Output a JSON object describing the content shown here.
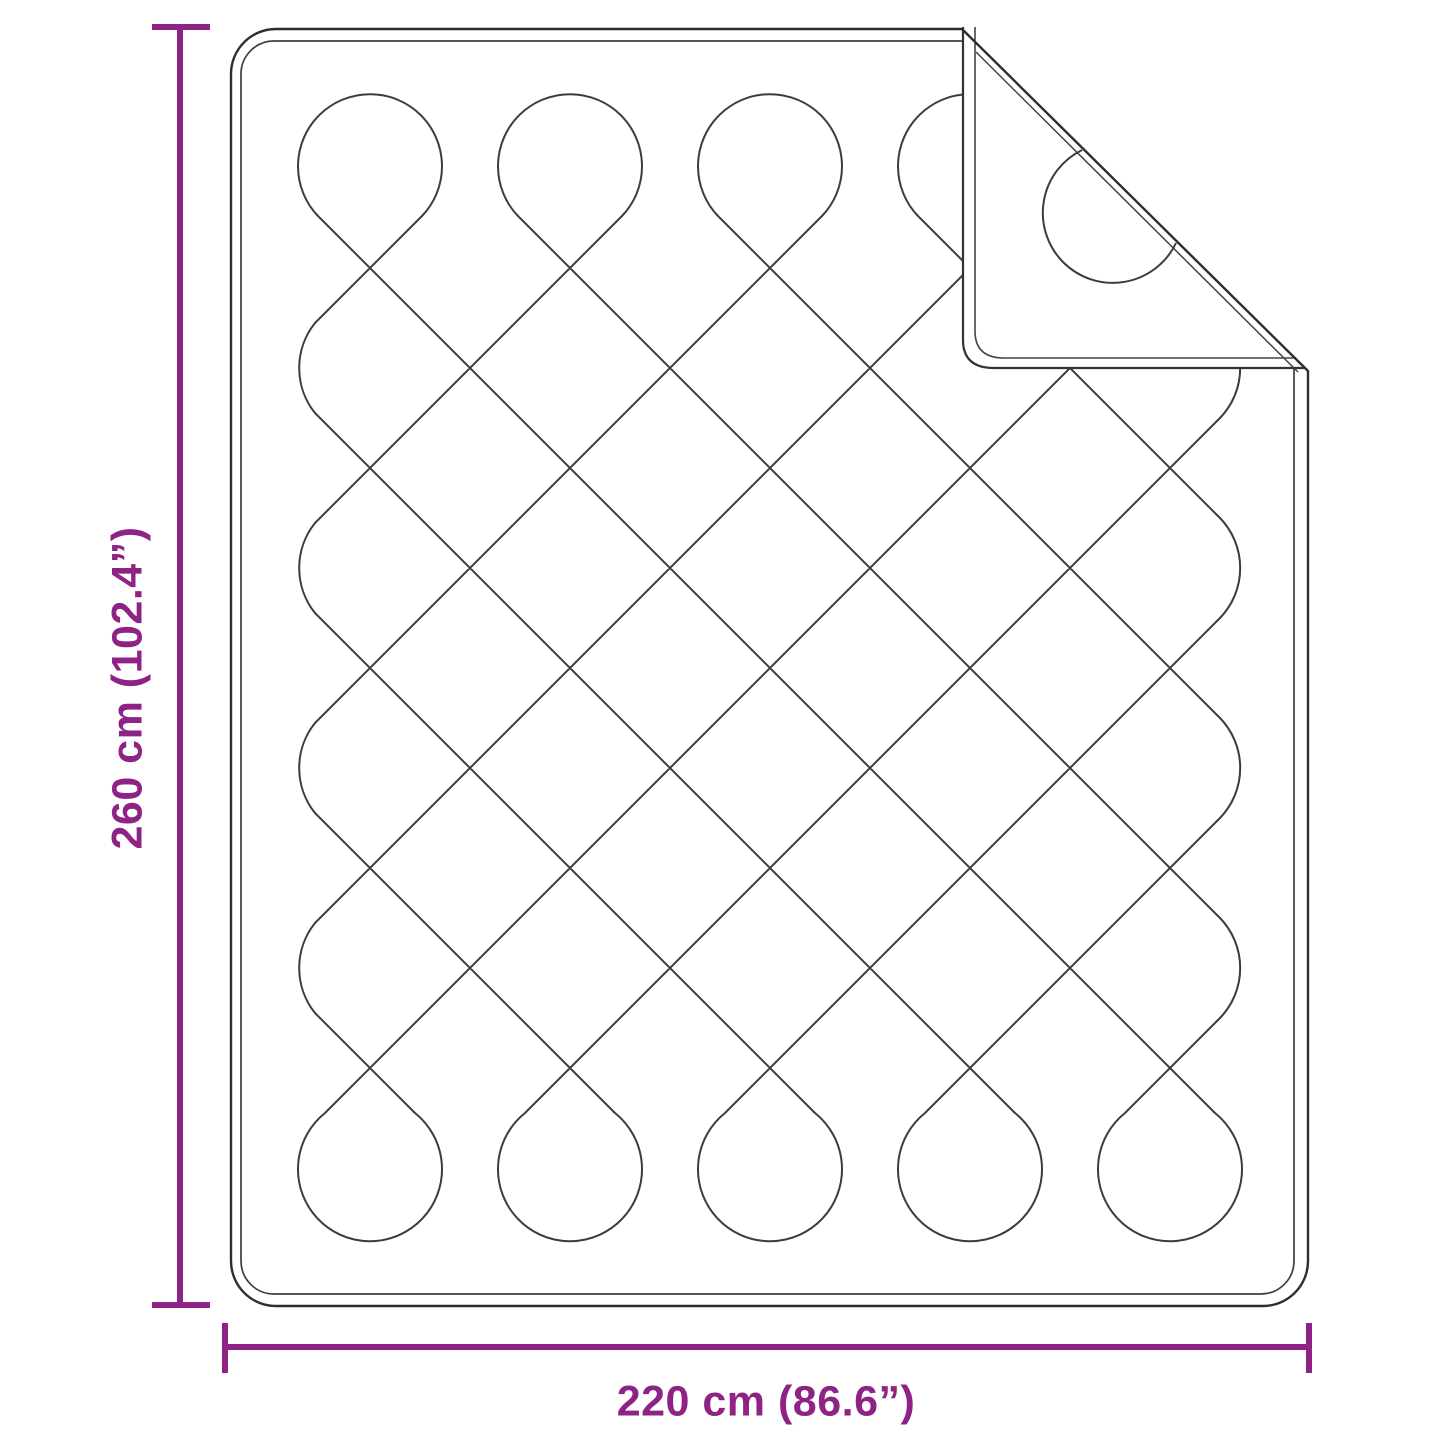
{
  "page": {
    "background": "#ffffff"
  },
  "diagram": {
    "description": "Quilted blanket dimension diagram with folded corner",
    "accent_color": "#8e2385",
    "outline_color": "#2e2e2e",
    "stitch_color": "#3c3c3c"
  },
  "labels": {
    "height": "260 cm (102.4”)",
    "width": "220 cm (86.6”)"
  }
}
